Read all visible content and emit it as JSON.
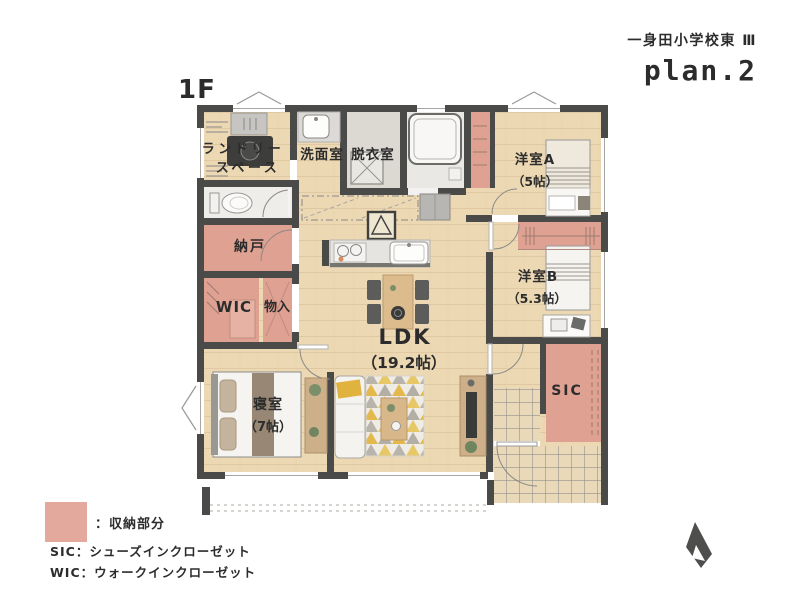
{
  "header": {
    "floor": "1F",
    "project": "一身田小学校東 Ⅲ",
    "plan": "plan.2"
  },
  "rooms": {
    "laundry1": "ランドリー",
    "laundry2": "スペース",
    "washroom": "洗面室",
    "dressing": "脱衣室",
    "bedroom_a": "洋室A",
    "bedroom_a_size": "（5帖）",
    "bedroom_b": "洋室B",
    "bedroom_b_size": "（5.3帖）",
    "nando": "納戸",
    "wic": "WIC",
    "monoire": "物入",
    "ldk": "LDK",
    "ldk_size": "（19.2帖）",
    "master": "寝室",
    "master_size": "（7帖）",
    "sic": "SIC"
  },
  "legend": {
    "swatch_label": "：収納部分",
    "sic_def": "SIC：シューズインクローゼット",
    "wic_def": "WIC：ウォークインクローゼット",
    "storage_color": "#e2a99c"
  },
  "colors": {
    "wall": "#4a4a48",
    "wood": "#ecd9b4",
    "storage_pink": "#dfa192",
    "entrance_tile": "#ead9b8",
    "rug_yellow": "#e3b84d"
  }
}
